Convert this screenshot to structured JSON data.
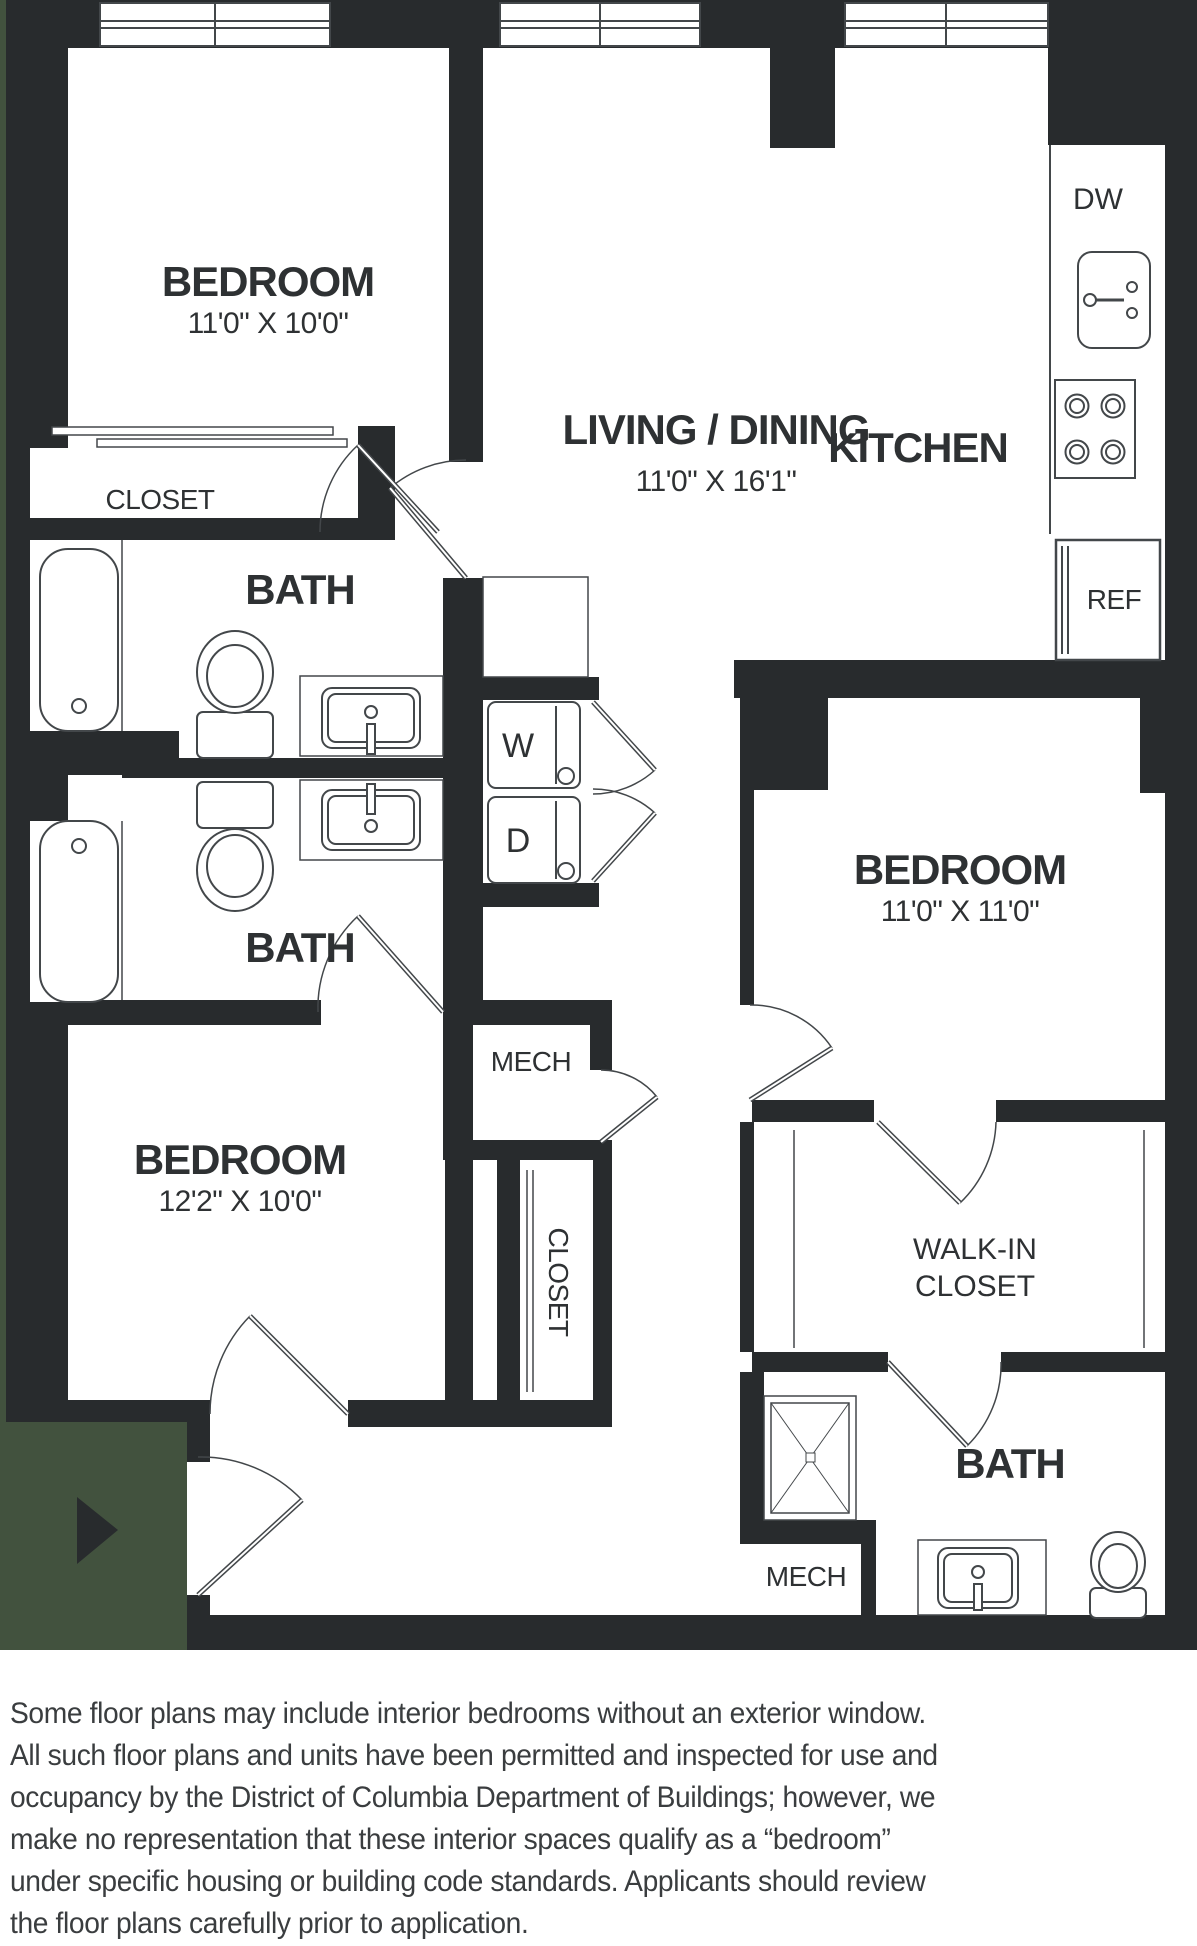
{
  "meta": {
    "wall_color": "#282b2d",
    "accent_green": "#42523e",
    "line_color": "#43474a",
    "text_color": "#2e3133"
  },
  "plan": {
    "bedroom1": {
      "name": "BEDROOM",
      "dims": "11'0\" X 10'0\""
    },
    "living": {
      "name": "LIVING / DINING",
      "dims": "11'0\" X 16'1\""
    },
    "kitchen": {
      "name": "KITCHEN"
    },
    "bedroom2": {
      "name": "BEDROOM",
      "dims": "11'0\" X 11'0\""
    },
    "bedroom3": {
      "name": "BEDROOM",
      "dims": "12'2\" X 10'0\""
    },
    "bath1": "BATH",
    "bath2": "BATH",
    "bath3": "BATH",
    "closet1": "CLOSET",
    "closet2": "CLOSET",
    "walkin": {
      "line1": "WALK-IN",
      "line2": "CLOSET"
    },
    "mech1": "MECH",
    "mech2": "MECH",
    "dishwasher": "DW",
    "refrigerator": "REF",
    "washer": "W",
    "dryer": "D"
  },
  "disclaimer": {
    "line1": "Some floor plans may include interior bedrooms without an exterior window.",
    "line2": "All such floor plans and units have been permitted and inspected for use and",
    "line3": "occupancy by the District of Columbia Department of Buildings; however, we",
    "line4": "make no representation that these interior spaces qualify as a “bedroom”",
    "line5": "under specific housing or building code standards. Applicants should review",
    "line6": "the floor plans carefully prior to application."
  }
}
